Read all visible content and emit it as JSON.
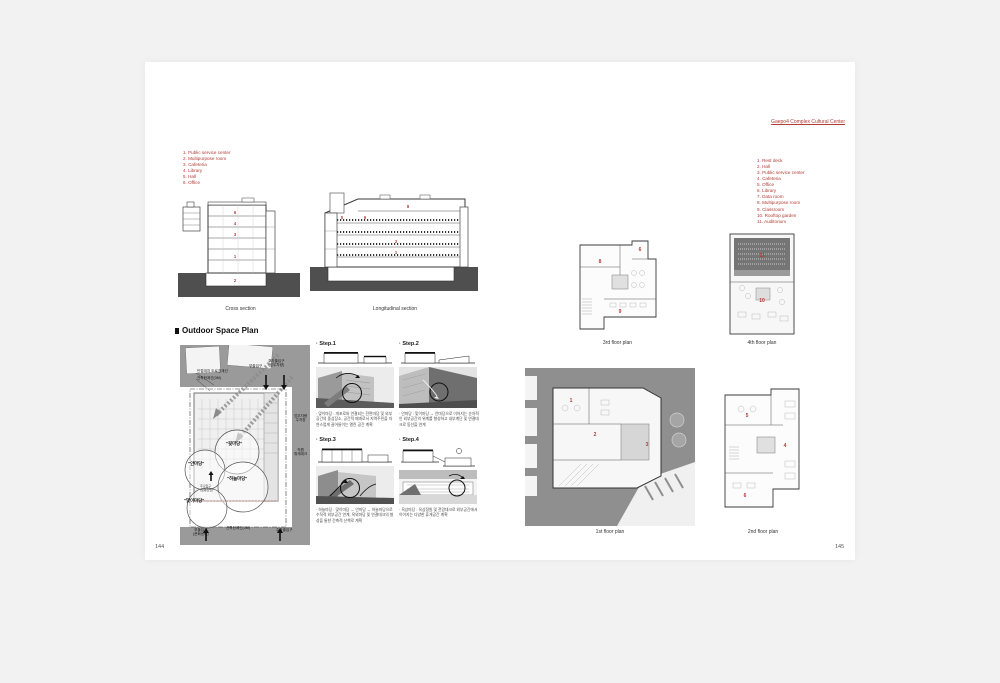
{
  "header": {
    "link": "Gaepo4 Complex Cultural Center"
  },
  "page_numbers": {
    "left": "144",
    "right": "145"
  },
  "legend_left": {
    "items": [
      "1. Public service center",
      "2. Multipurpose room",
      "3. Cafeteria",
      "4. Library",
      "5. Hall",
      "6. Office"
    ]
  },
  "legend_right": {
    "items": [
      "1. Rest deck",
      "2. Hall",
      "3. Public service center",
      "4. Cafeteria",
      "5. Office",
      "6. Library",
      "7. Data room",
      "8. Multipurpose room",
      "9. Classroom",
      "10. Rooftop garden",
      "11. Auditorium"
    ]
  },
  "outdoor": {
    "heading": "Outdoor Space Plan",
    "site_labels": {
      "road_boundary": "인접대지 도로경계선",
      "build_limit_top": "건축한계선(3M)",
      "sub_entrance_top": "부출입구",
      "parking_entrance_top": "주차출입구\n(업무차량)",
      "staff_parking": "업무차량\n주차장",
      "staff_deck": "직원\n휴게데크",
      "yard_back": "\"뒷마당\"",
      "yard_inner": "\"안마당\"",
      "yard_sky": "\"하늘마당\"",
      "yard_welcome": "\"맞이마당\"",
      "main_entrance": "주출입구\n(보행진입)",
      "sub_entrance_bottom": "부출입구\n(문화센터)",
      "build_limit_bottom": "건축한계선(3M)",
      "parking_entrance_bottom": "주차출입구"
    },
    "steps": [
      {
        "label": "· Step.1",
        "caption": "· 맞이마당 : 개포로와 연결되는 전면마당 및 외부공간의 중심장소, 공간적 매개로서 지역주민을 자연스럽게 끌어들이는 열린 공간 계획"
      },
      {
        "label": "· Step.2",
        "caption": "· 안마당 : 맞이마당 → 안마당으로 이어지는 순차적인 외부공간의 위계를 형성하고 내부계단 및 연결데크로 동선을 연계"
      },
      {
        "label": "· Step.3",
        "caption": "· 하늘마당 : 맞이마당 → 안마당 → 하늘마당으로 수직적 외부공간 연계, 옥외마당 및 연결데크의 형성을 통한 건축적 산책로 계획"
      },
      {
        "label": "· Step.4",
        "caption": "· 옥상마당 : 옥상정원 및 전망데크로 외부공간에서 이어지는 다양한 휴게공간 계획"
      }
    ]
  },
  "plans": {
    "cross": {
      "caption": "Cross section",
      "numbers": [
        "6",
        "4",
        "3",
        "1",
        "2"
      ]
    },
    "longitudinal": {
      "caption": "Longitudinal section",
      "numbers": [
        "8",
        "6",
        "5",
        "2",
        "1"
      ]
    },
    "third": {
      "caption": "3rd floor plan",
      "numbers": [
        "8",
        "6",
        "9"
      ]
    },
    "fourth": {
      "caption": "4th floor plan",
      "numbers": [
        "11",
        "10"
      ]
    },
    "first": {
      "caption": "1st floor plan",
      "numbers": [
        "2",
        "3",
        "1"
      ]
    },
    "second": {
      "caption": "2nd floor plan",
      "numbers": [
        "5",
        "4",
        "6"
      ]
    }
  },
  "colors": {
    "accent_red": "#b23c34",
    "ground_dark": "#4f4f4f",
    "site_gray": "#8f8f8f",
    "page_bg": "#ffffff",
    "canvas_bg": "#f2f2f3"
  }
}
